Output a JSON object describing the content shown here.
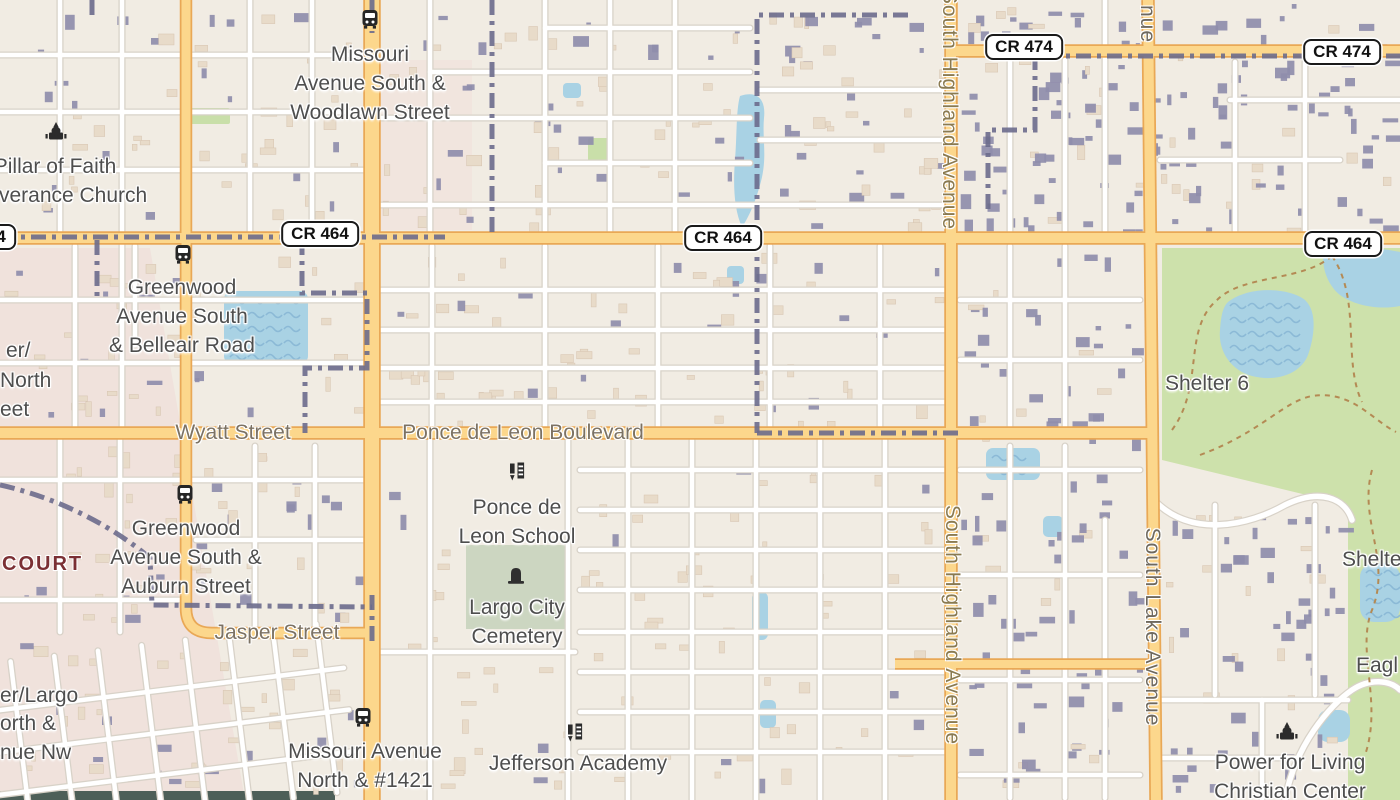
{
  "map": {
    "title": "Largo street map",
    "colors": {
      "land": "#f1ece3",
      "residential_pink": "#f0e2dc",
      "road_major_fill": "#fcd78c",
      "road_major_casing": "#e9a856",
      "road_minor_fill": "#ffffff",
      "road_minor_casing": "#d8d2c8",
      "water": "#a9d2e4",
      "water_wave": "#8bb9d6",
      "park": "#cde1ab",
      "park_small": "#c9dfa9",
      "cemetery_green": "#ccd6c1",
      "building_dark": "#8f8dab",
      "building_light": "#e8dbc9",
      "boundary": "#6b6b8c",
      "trail": "#b48a54",
      "poi_label": "#4e4e4e",
      "road_label": "#7c7263",
      "district_label": "#7b3034",
      "dark_strip": "#4d5f58"
    },
    "shields": [
      {
        "label": "CR 464",
        "x": -23,
        "y": 237
      },
      {
        "label": "CR 464",
        "x": 320,
        "y": 234
      },
      {
        "label": "CR 464",
        "x": 723,
        "y": 238
      },
      {
        "label": "CR 464",
        "x": 1343,
        "y": 244
      },
      {
        "label": "CR 474",
        "x": 1024,
        "y": 47
      },
      {
        "label": "CR 474",
        "x": 1342,
        "y": 52
      }
    ],
    "road_labels": [
      {
        "text": "Wyatt Street",
        "x": 233,
        "y": 433,
        "dir": "h",
        "cls": ""
      },
      {
        "text": "Ponce de Leon Boulevard",
        "x": 523,
        "y": 433,
        "dir": "h",
        "cls": ""
      },
      {
        "text": "Jasper Street",
        "x": 277,
        "y": 633,
        "dir": "h",
        "cls": ""
      },
      {
        "text": "South Highland Avenue",
        "x": 949,
        "y": 110,
        "dir": "v",
        "cls": "hw"
      },
      {
        "text": "South Highland Avenue",
        "x": 952,
        "y": 625,
        "dir": "v",
        "cls": "hw"
      },
      {
        "text": "South Lake Avenue",
        "x": 1152,
        "y": 627,
        "dir": "v",
        "cls": "lk"
      },
      {
        "text": "nue",
        "x": 1147,
        "y": 24,
        "dir": "v",
        "cls": "lk"
      }
    ],
    "poi_labels": [
      {
        "name": "missouri-ave-s-woodlawn-st-stop",
        "x": 370,
        "top": 40,
        "lines": [
          "Missouri",
          "Avenue South &",
          "Woodlawn Street"
        ]
      },
      {
        "name": "pillar-of-faith-church",
        "x": 55,
        "top": 152,
        "lines": [
          "Pillar of Faith",
          "Deliverance Church"
        ]
      },
      {
        "name": "greenwood-ave-s-belleair-stop",
        "x": 182,
        "top": 273,
        "lines": [
          "Greenwood",
          "Avenue South",
          "& Belleair Road"
        ]
      },
      {
        "name": "greenwood-ave-s-auburn-stop",
        "x": 186,
        "top": 514,
        "lines": [
          "Greenwood",
          "Avenue South &",
          "Auburn Street"
        ]
      },
      {
        "name": "ponce-de-leon-school",
        "x": 517,
        "top": 493,
        "lines": [
          "Ponce de",
          "Leon School"
        ]
      },
      {
        "name": "largo-city-cemetery",
        "x": 517,
        "top": 593,
        "lines": [
          "Largo City",
          "Cemetery"
        ]
      },
      {
        "name": "missouri-ave-n-1421-stop",
        "x": 365,
        "top": 737,
        "lines": [
          "Missouri Avenue",
          "North & #1421"
        ]
      },
      {
        "name": "jefferson-academy",
        "x": 578,
        "top": 749,
        "lines": [
          "Jefferson Academy"
        ]
      },
      {
        "name": "power-for-living-center",
        "x": 1290,
        "top": 748,
        "lines": [
          "Power for Living",
          "Christian Center"
        ]
      },
      {
        "name": "shelter-6",
        "x": 1207,
        "top": 369,
        "lines": [
          "Shelter 6"
        ]
      }
    ],
    "partial_labels": [
      {
        "text": "er/",
        "x": 6,
        "top": 336
      },
      {
        "text": "North",
        "x": 0,
        "top": 366
      },
      {
        "text": "eet",
        "x": 0,
        "top": 395
      },
      {
        "text": "er/Largo",
        "x": 0,
        "top": 681
      },
      {
        "text": "orth &",
        "x": 0,
        "top": 709
      },
      {
        "text": "nue Nw",
        "x": 0,
        "top": 738
      },
      {
        "text": "Shelte",
        "x": 1342,
        "top": 545
      },
      {
        "text": "Eagl",
        "x": 1356,
        "top": 651
      }
    ],
    "district_labels": [
      {
        "text": "COURT",
        "x": 2,
        "top": 553
      }
    ],
    "icons": [
      {
        "type": "bus-stop",
        "x": 370,
        "y": 22
      },
      {
        "type": "church",
        "x": 56,
        "y": 134
      },
      {
        "type": "bus-stop",
        "x": 183,
        "y": 257
      },
      {
        "type": "bus-stop",
        "x": 185,
        "y": 497
      },
      {
        "type": "school",
        "x": 517,
        "y": 474
      },
      {
        "type": "cemetery",
        "x": 516,
        "y": 578
      },
      {
        "type": "bus-stop",
        "x": 363,
        "y": 720
      },
      {
        "type": "school",
        "x": 575,
        "y": 735
      },
      {
        "type": "church",
        "x": 1287,
        "y": 734
      }
    ]
  }
}
